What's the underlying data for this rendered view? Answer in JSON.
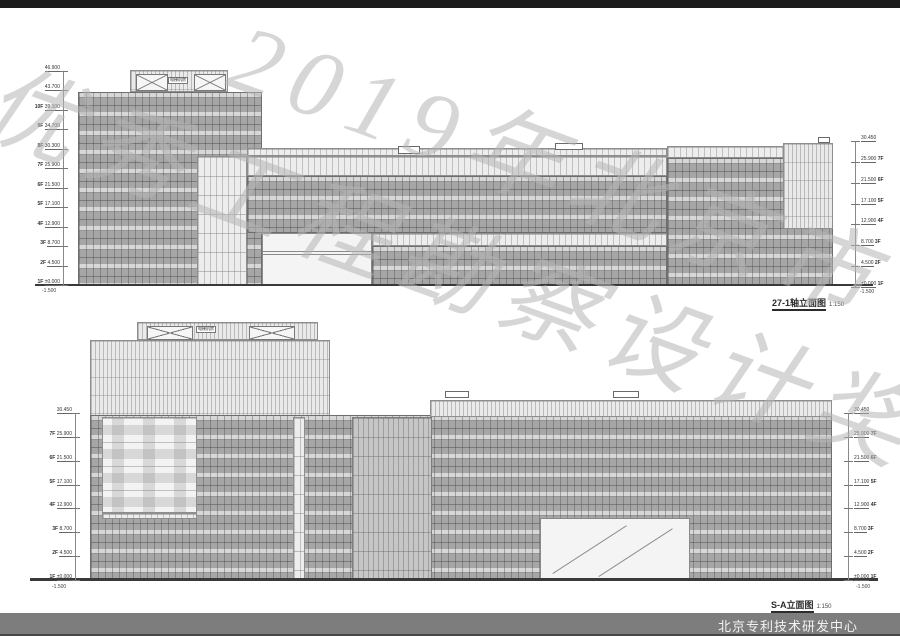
{
  "sheet": {
    "watermark": {
      "line1": "2019年北京市",
      "line2": "优秀工程勘察设计奖"
    },
    "footer": {
      "project_name": "北京专利技术研发中心"
    }
  },
  "drawings": {
    "elev1": {
      "title": "27-1轴立面图",
      "scale": "1:150",
      "roof_label": "电梯机房",
      "below_grade": "-1.500",
      "ladder_left": {
        "rows": [
          {
            "floor": "",
            "elev": "46.900"
          },
          {
            "floor": "",
            "elev": "43.700"
          },
          {
            "floor": "10F",
            "elev": "39.100"
          },
          {
            "floor": "9F",
            "elev": "34.700"
          },
          {
            "floor": "8F",
            "elev": "30.300"
          },
          {
            "floor": "7F",
            "elev": "25.900"
          },
          {
            "floor": "6F",
            "elev": "21.500"
          },
          {
            "floor": "5F",
            "elev": "17.100"
          },
          {
            "floor": "4F",
            "elev": "12.900"
          },
          {
            "floor": "3F",
            "elev": "8.700"
          },
          {
            "floor": "2F",
            "elev": "4.500"
          },
          {
            "floor": "1F",
            "elev": "±0.000"
          }
        ]
      },
      "ladder_right": {
        "rows": [
          {
            "floor": "",
            "elev": "30.450"
          },
          {
            "floor": "7F",
            "elev": "25.900"
          },
          {
            "floor": "6F",
            "elev": "21.500"
          },
          {
            "floor": "5F",
            "elev": "17.100"
          },
          {
            "floor": "4F",
            "elev": "12.900"
          },
          {
            "floor": "3F",
            "elev": "8.700"
          },
          {
            "floor": "2F",
            "elev": "4.500"
          },
          {
            "floor": "1F",
            "elev": "±0.000"
          }
        ]
      }
    },
    "elev2": {
      "title": "S-A立面图",
      "scale": "1:150",
      "roof_label": "电梯机房",
      "below_grade": "-1.500",
      "ladder_left": {
        "rows": [
          {
            "floor": "",
            "elev": "30.450"
          },
          {
            "floor": "7F",
            "elev": "25.900"
          },
          {
            "floor": "6F",
            "elev": "21.500"
          },
          {
            "floor": "5F",
            "elev": "17.100"
          },
          {
            "floor": "4F",
            "elev": "12.900"
          },
          {
            "floor": "3F",
            "elev": "8.700"
          },
          {
            "floor": "2F",
            "elev": "4.500"
          },
          {
            "floor": "1F",
            "elev": "±0.000"
          }
        ]
      },
      "ladder_right": {
        "rows": [
          {
            "floor": "",
            "elev": "30.450"
          },
          {
            "floor": "7F",
            "elev": "25.900"
          },
          {
            "floor": "6F",
            "elev": "21.500"
          },
          {
            "floor": "5F",
            "elev": "17.100"
          },
          {
            "floor": "4F",
            "elev": "12.900"
          },
          {
            "floor": "3F",
            "elev": "8.700"
          },
          {
            "floor": "2F",
            "elev": "4.500"
          },
          {
            "floor": "1F",
            "elev": "±0.000"
          }
        ]
      }
    }
  }
}
